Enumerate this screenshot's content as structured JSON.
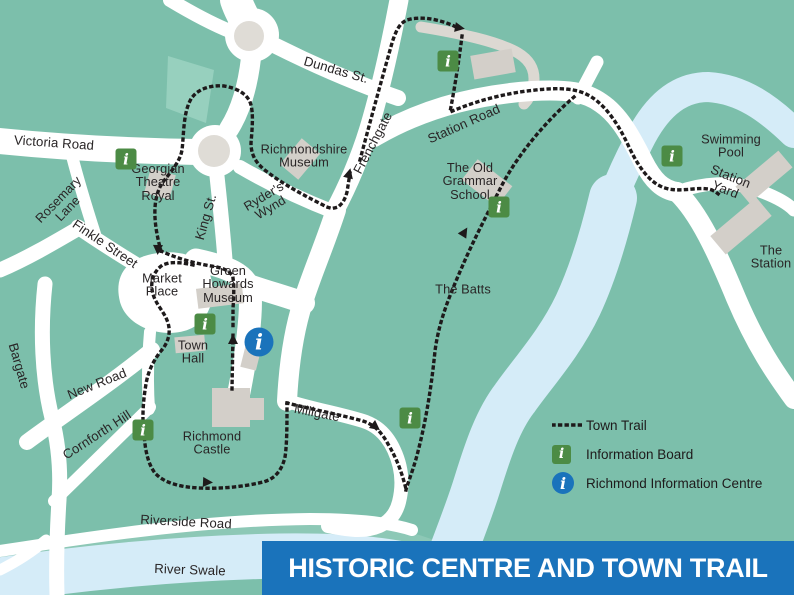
{
  "banner": {
    "title": "HISTORIC CENTRE AND TOWN TRAIL"
  },
  "legend": {
    "trail_label": "Town Trail",
    "board_label": "Information Board",
    "centre_label": "Richmond Information Centre"
  },
  "icons": {
    "board_glyph": "i",
    "centre_glyph": "i"
  },
  "colors": {
    "background_green": "#7cbfab",
    "river_blue": "#d5ecf8",
    "road_white": "#ffffff",
    "building_grey": "#d3cfc9",
    "board_green": "#4c8b45",
    "info_blue": "#1a73bb",
    "trail_black": "#1e1a1b"
  },
  "labels": {
    "victoria": "Victoria Road",
    "rosemary": "Rosemary\nLane",
    "finkle": "Finkle Street",
    "bargate": "Bargate",
    "king": "King St.",
    "dundas": "Dundas St.",
    "frenchgate": "Frenchgate",
    "richmondshire": "Richmondshire\nMuseum",
    "ryders": "Ryder's\nWynd",
    "georgian": "Georgian\nTheatre\nRoyal",
    "market": "Market\nPlace",
    "ghm": "Green\nHowards\nMuseum",
    "townhall": "Town\nHall",
    "castle": "Richmond\nCastle",
    "newroad": "New Road",
    "cornforth": "Cornforth Hill",
    "millgate": "Millgate",
    "riverside": "Riverside Road",
    "riverswale": "River Swale",
    "stationroad": "Station Road",
    "grammar": "The Old\nGrammar\nSchool",
    "batts": "The Batts",
    "pool": "Swimming\nPool",
    "stationyard": "Station Yard",
    "station": "The\nStation"
  }
}
